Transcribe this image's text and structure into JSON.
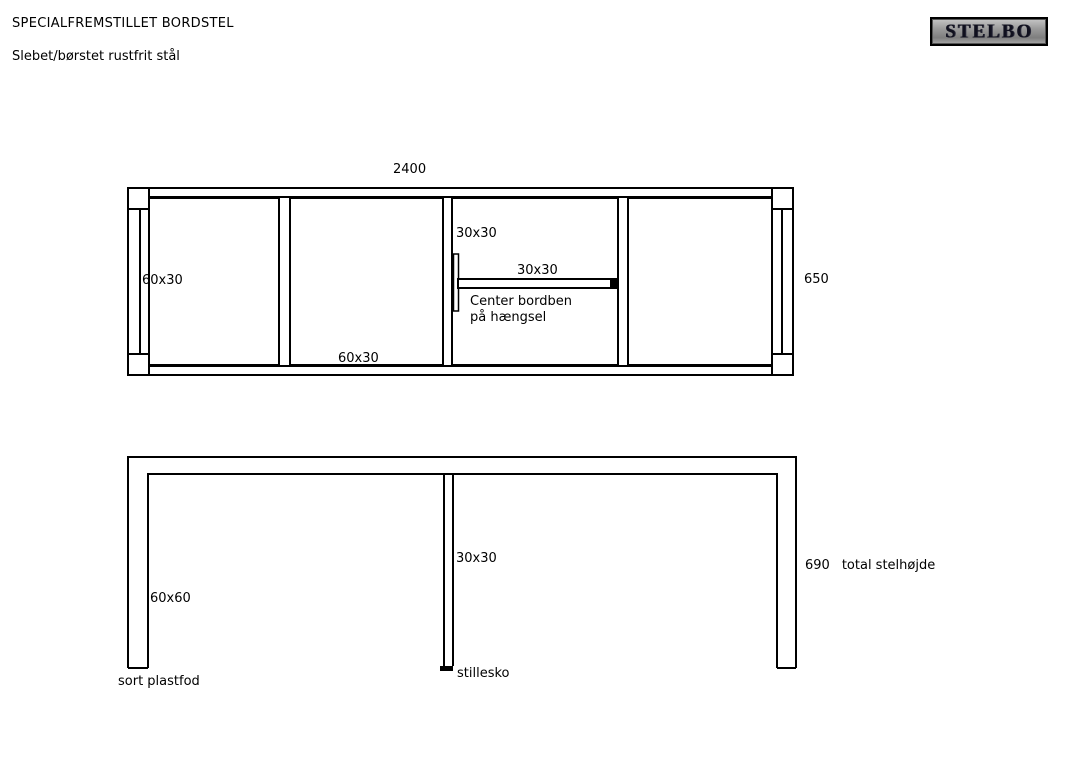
{
  "header": {
    "title": "SPECIALFREMSTILLET BORDSTEL",
    "subtitle": "Slebet/børstet rustfrit stål"
  },
  "logo": {
    "text": "STELBO"
  },
  "colors": {
    "line": "#000000",
    "background": "#ffffff",
    "logo_border": "#000000",
    "logo_background": "#9a9a9a",
    "logo_text": "#10101e"
  },
  "top_view": {
    "dim_length": "2400",
    "dim_depth": "650",
    "side_member_label": "60x30",
    "cross_member_label": "60x30",
    "hinge_member_label": "30x30",
    "center_bar_label": "30x30",
    "note_line1": "Center bordben",
    "note_line2": "på hængsel"
  },
  "side_view": {
    "leg_label": "60x60",
    "center_leg_label": "30x30",
    "height_value": "690",
    "height_label": "total stelhøjde",
    "foot_label": "sort plastfod",
    "glide_label": "stillesko"
  }
}
